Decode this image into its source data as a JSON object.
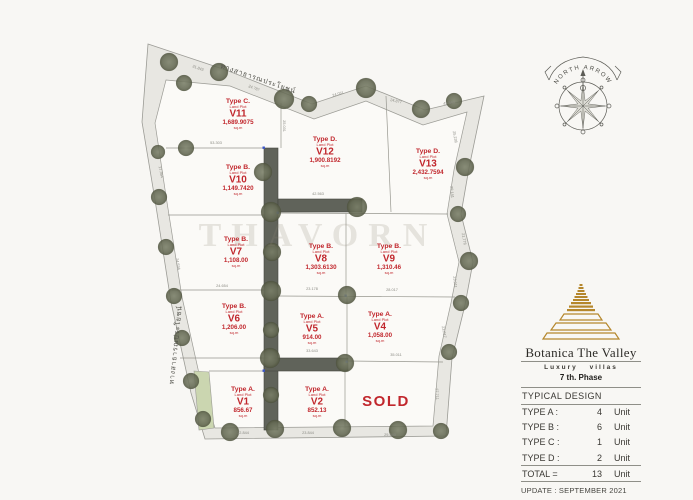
{
  "site": {
    "watermark": "THAVORN",
    "sold_label": "SOLD",
    "compass_label": "NORTH  ARROW",
    "road_label_top": "ทางสาธารณประโยชน์",
    "road_label_left": "ทางสาธารณประโยชน์"
  },
  "plots": [
    {
      "type": "Type C.",
      "sub": "Land Plot",
      "code": "V11",
      "area": "1,689.9075",
      "unit": "sq.m"
    },
    {
      "type": "Type B.",
      "sub": "Land Plot",
      "code": "V10",
      "area": "1,149.7420",
      "unit": "sq.m"
    },
    {
      "type": "Type D.",
      "sub": "Land Plot",
      "code": "V12",
      "area": "1,900.8192",
      "unit": "sq.m"
    },
    {
      "type": "Type D.",
      "sub": "Land Plot",
      "code": "V13",
      "area": "2,432.7594",
      "unit": "sq.m"
    },
    {
      "type": "Type B.",
      "sub": "Land Plot",
      "code": "V7",
      "area": "1,108.00",
      "unit": "sq.m"
    },
    {
      "type": "Type B.",
      "sub": "Land Plot",
      "code": "V8",
      "area": "1,303.6130",
      "unit": "sq.m"
    },
    {
      "type": "Type B.",
      "sub": "Land Plot",
      "code": "V9",
      "area": "1,310.46",
      "unit": "sq.m"
    },
    {
      "type": "Type B.",
      "sub": "Land Plot",
      "code": "V6",
      "area": "1,206.00",
      "unit": "sq.m"
    },
    {
      "type": "Type A.",
      "sub": "Land Plot",
      "code": "V5",
      "area": "914.00",
      "unit": "sq.m"
    },
    {
      "type": "Type A.",
      "sub": "Land Plot",
      "code": "V4",
      "area": "1,058.00",
      "unit": "sq.m"
    },
    {
      "type": "Type A.",
      "sub": "Land Plot",
      "code": "V1",
      "area": "856.67",
      "unit": "sq.m"
    },
    {
      "type": "Type A.",
      "sub": "Land Plot",
      "code": "V2",
      "area": "852.13",
      "unit": "sq.m"
    }
  ],
  "dims": [
    "31.843",
    "24.787",
    "24.031",
    "24.877",
    "43.343",
    "25.236",
    "29.141",
    "21.776",
    "23.011",
    "23.017",
    "27.711",
    "53.303",
    "42.563",
    "23.178",
    "28.017",
    "24.654",
    "24.634",
    "17.364",
    "33.643",
    "35.011",
    "12.844",
    "23.844",
    "29.540",
    "25.031"
  ],
  "legend": {
    "brand": "Botanica The Valley",
    "tagline": "Luxury villas",
    "phase": "7 th. Phase",
    "section_title": "TYPICAL DESIGN",
    "rows": [
      {
        "label": "TYPE A :",
        "count": "4",
        "unit": "Unit"
      },
      {
        "label": "TYPE B :",
        "count": "6",
        "unit": "Unit"
      },
      {
        "label": "TYPE C :",
        "count": "1",
        "unit": "Unit"
      },
      {
        "label": "TYPE D :",
        "count": "2",
        "unit": "Unit"
      }
    ],
    "total_label": "TOTAL =",
    "total_count": "13",
    "total_unit": "Unit",
    "update": "UPDATE : SEPTEMBER 2021"
  },
  "colors": {
    "plot_text_red": "#c1272d",
    "brand_gold": "#b5872c",
    "road_dark": "#60635a",
    "road_band": "#e8e7e2",
    "background": "#f8f7f4"
  }
}
